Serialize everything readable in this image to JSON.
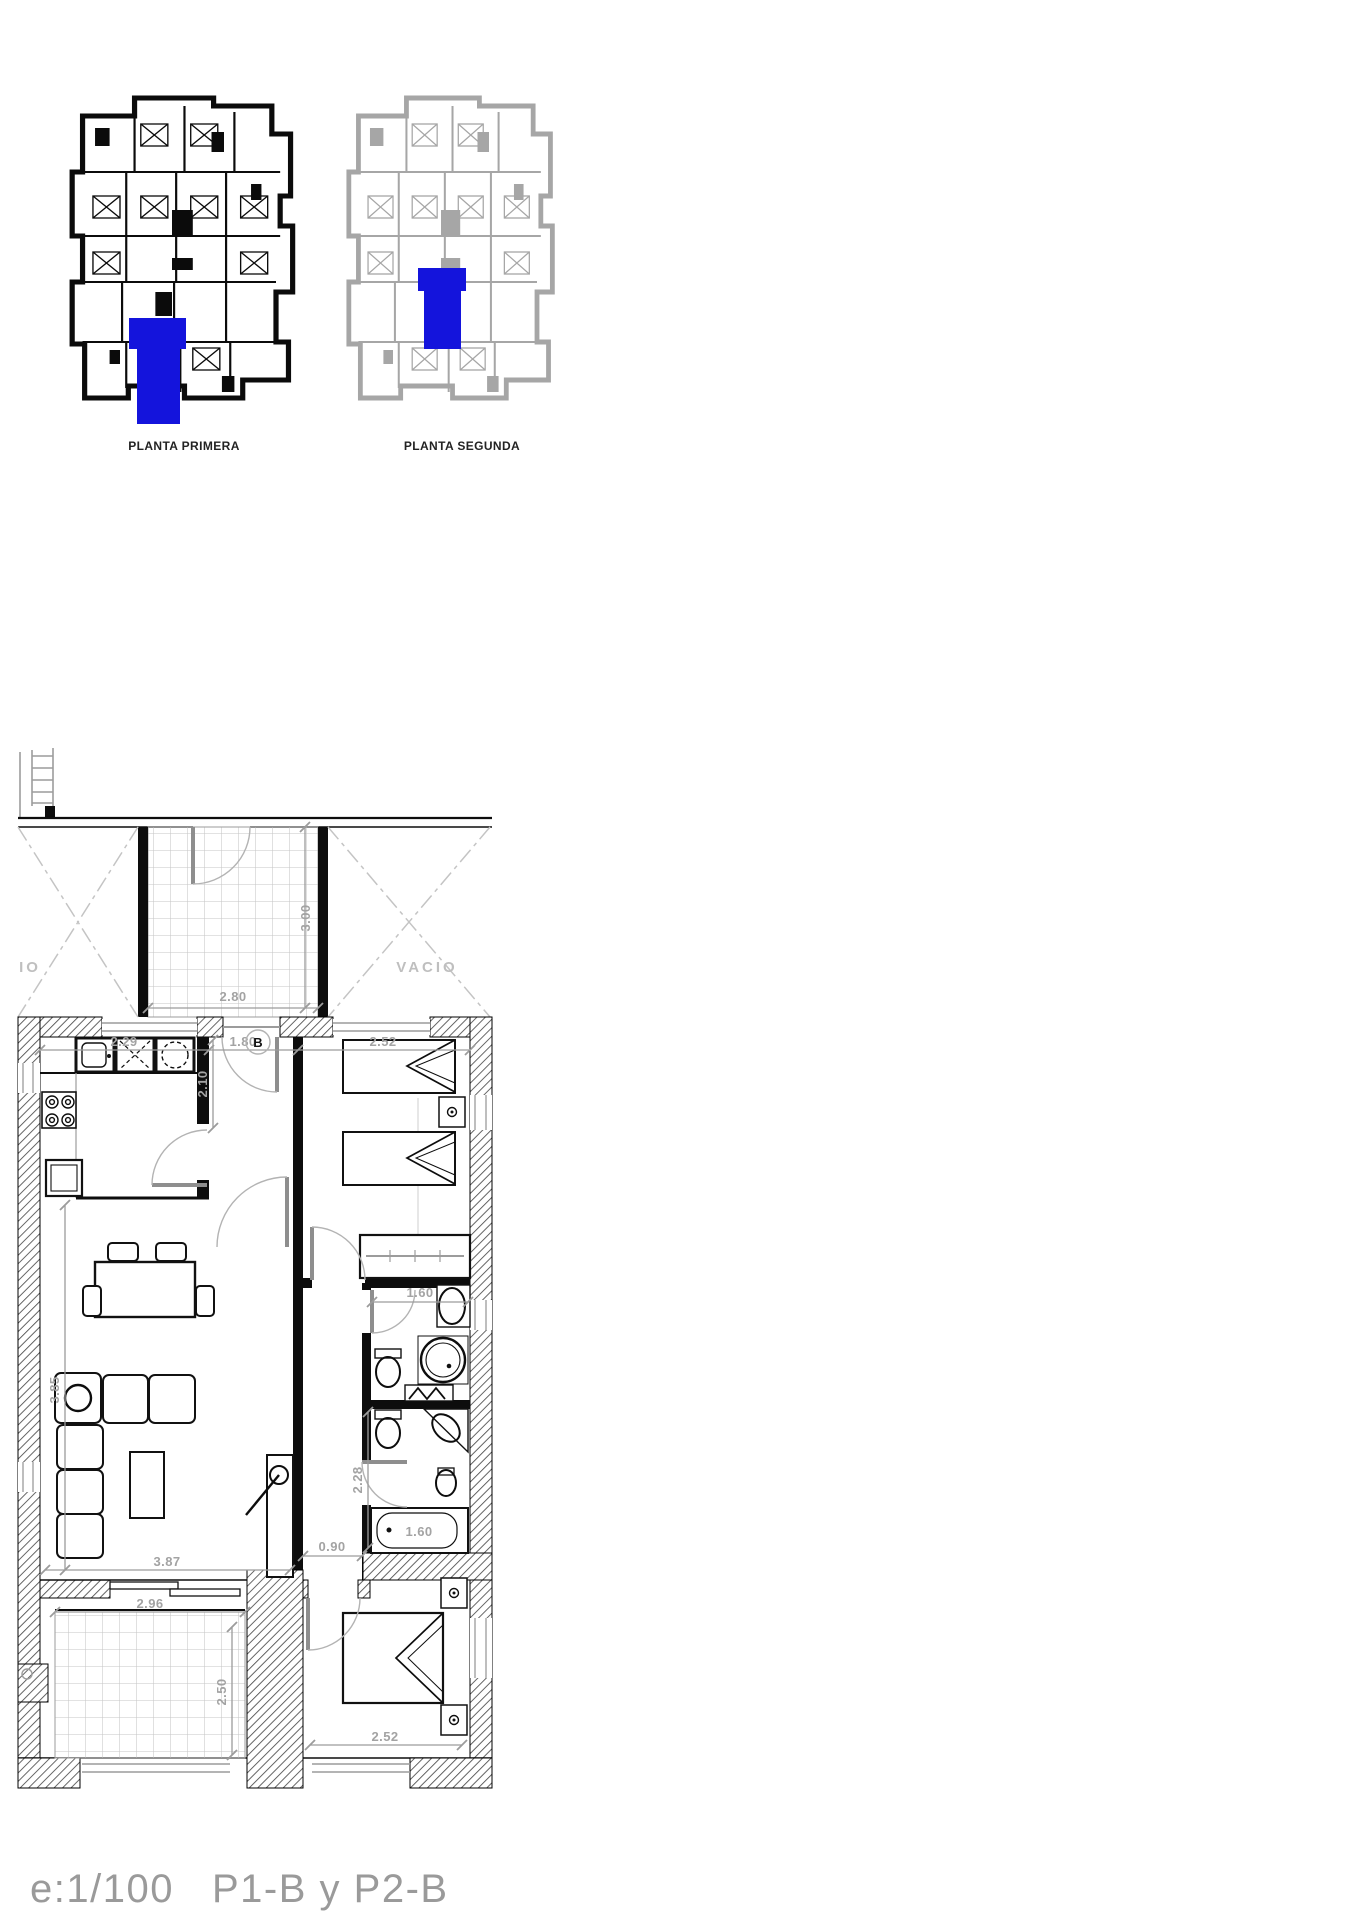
{
  "colors": {
    "highlight": "#1414dc"
  },
  "overview": {
    "first_floor_label": "PLANTA PRIMERA",
    "second_floor_label": "PLANTA SEGUNDA"
  },
  "plan": {
    "void_left": "IO",
    "void_right": "VACIO",
    "unit_letter": "B",
    "dims": {
      "patio_width": "2.80",
      "patio_depth": "3.00",
      "kitchen_width": "2.29",
      "kitchen_depth": "2.10",
      "hall_width": "1.80",
      "bedroom2_width": "2.52",
      "living_width": "3.87",
      "living_depth": "3.85",
      "corridor_width": "0.90",
      "bath_depth": "2.28",
      "bath1_width": "1.60",
      "bathtub_length": "1.60",
      "terrace_width": "2.96",
      "terrace_depth": "2.50",
      "bedroom1_width": "2.52"
    }
  },
  "footer": {
    "scale": "e:1/100",
    "units": "P1-B y P2-B"
  }
}
